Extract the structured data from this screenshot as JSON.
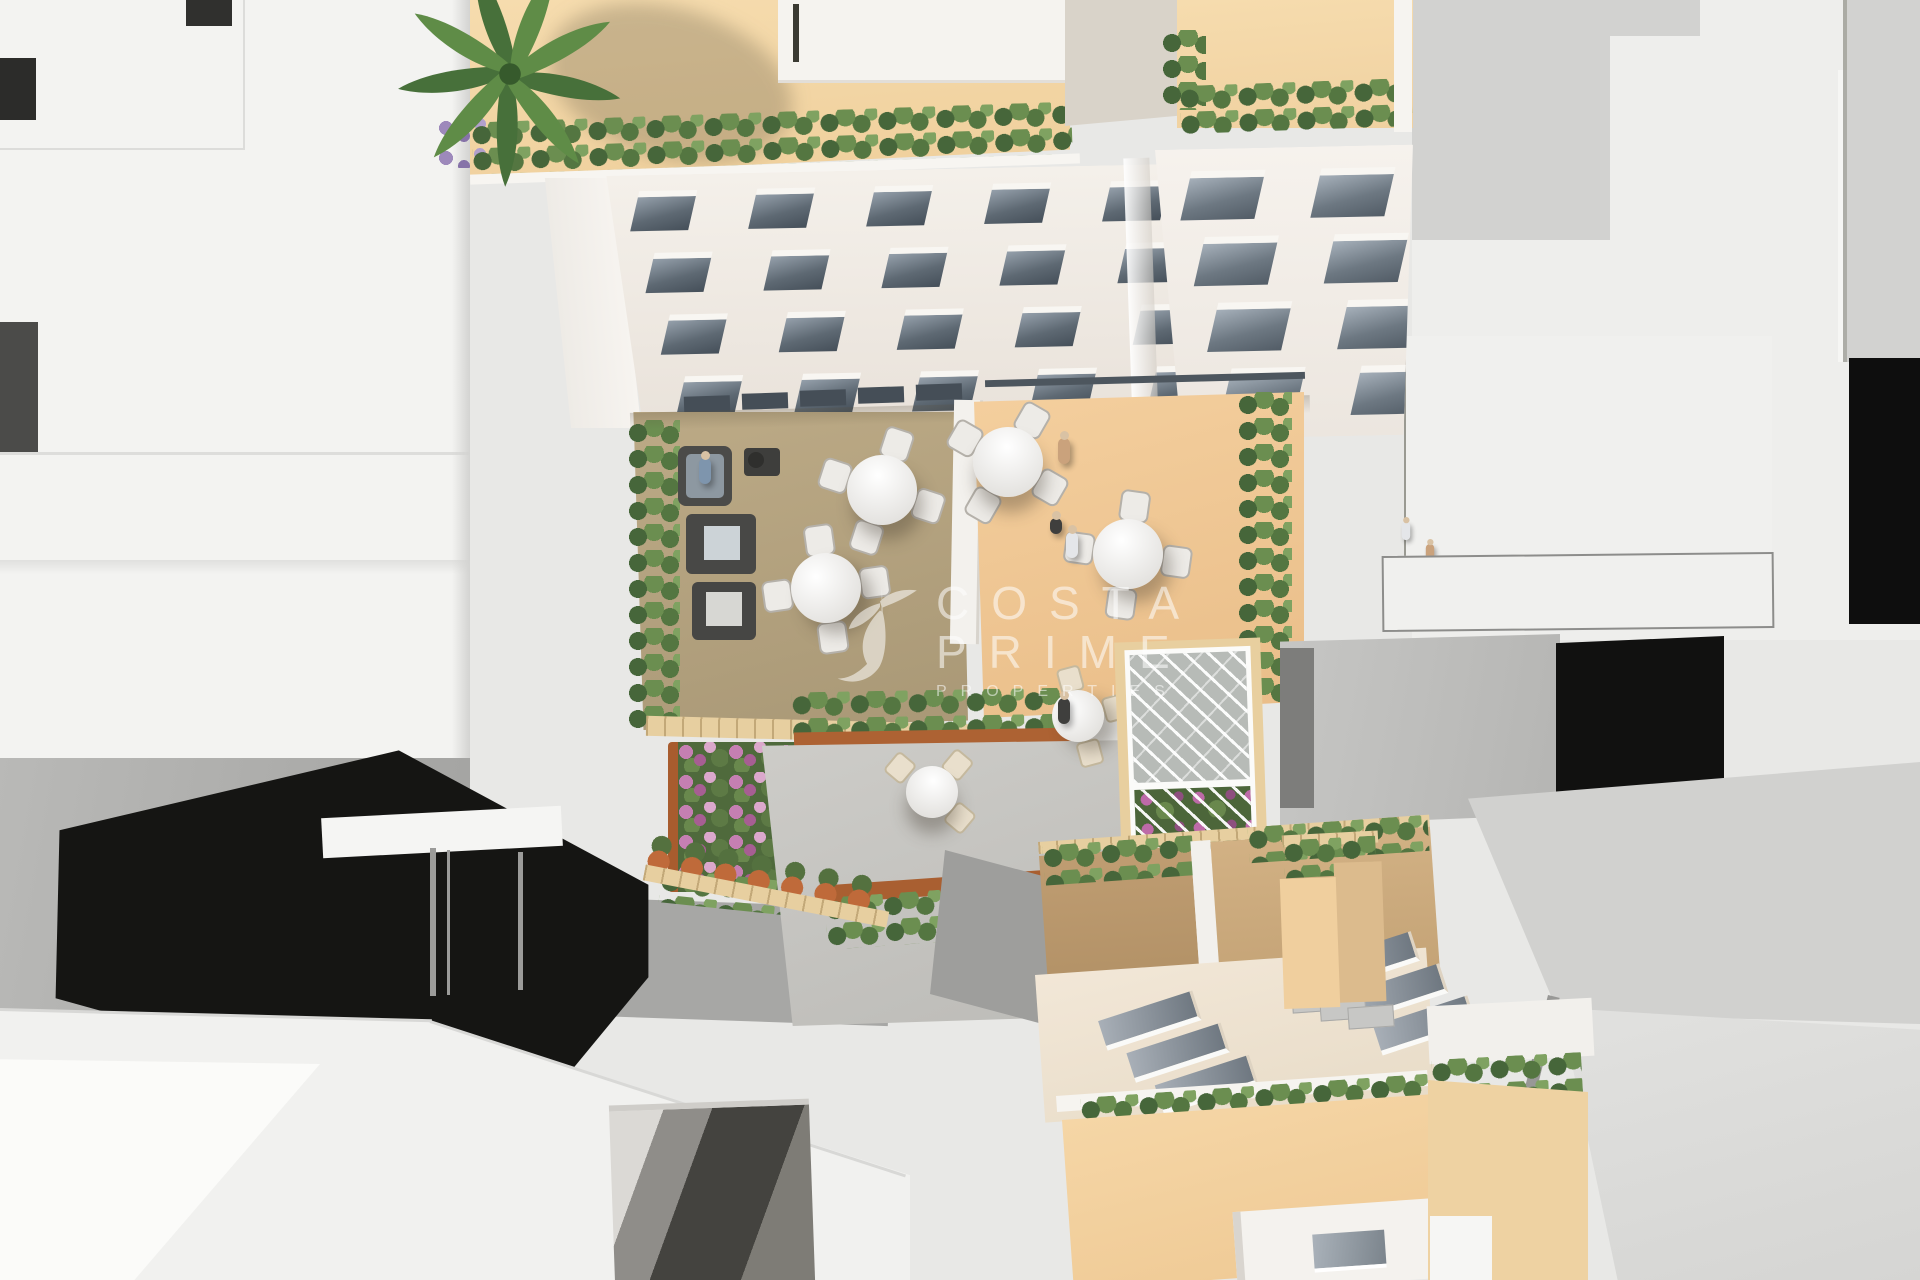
{
  "image": {
    "type": "3d-aerial-architectural-render",
    "description": "Top-down aerial 3D rendering of a residential apartment complex: rooftop terraces with hedges and a palm tree, two courtyard terraces with round dining tables and a lounge set, a lower garden patio with bistro tables, corten planters, flower beds and a white pergola trellis, a lower building with skylights and a peach courtyard, all surrounded by abstract white and gray massing-model buildings with hard shadows.",
    "width_px": 1920,
    "height_px": 1280
  },
  "watermark": {
    "line1": "COSTA",
    "line2": "PRIME",
    "line3": "PROPERTIES",
    "logo": "hummingbird-swoosh",
    "text_color": "#ffffff",
    "opacity": 0.55
  },
  "palette": {
    "background_gray": "#e8e8e6",
    "white_roof": "#f3f3f1",
    "terrace_beige": "#f4d8a8",
    "terrace_peach": "#eec795",
    "terrace_olive": "#b5a283",
    "facade_white": "#f2eee9",
    "window_glass": "#5c6771",
    "hedge_green": "#5e7c48",
    "palm_green": "#4d7a3a",
    "flower_pink": "#c783b5",
    "planter_corten": "#ab6132",
    "concrete_patio": "#c6c5c1",
    "cream_roof": "#eee3d2",
    "tan_wall": "#c7a679",
    "shadow_black": "#121210",
    "neutral_gray": "#bdbdbb"
  },
  "scene": {
    "regions": [
      "main-apartment-building with rooftop terrace, palm tree, perimeter hedges and two window facades",
      "courtyard-left-terrace (olive floor): sofa lounge set, two ottomans, two round 4-chair tables",
      "courtyard-right-terrace (peach floor): two round 4-chair tables",
      "garden-patio: concrete paving, two bistro tables, corten planters, pink flower bed, terracotta pots, white pergola trellis",
      "bottom-building: tan roof terraces, cream roof with six skylights, hedge row, peach courtyard, white penthouse",
      "surrounding massing blocks: untextured white and gray volumes with hard black shadows"
    ],
    "people_count": 7,
    "round_tables": 4,
    "bistro_tables": 2
  }
}
